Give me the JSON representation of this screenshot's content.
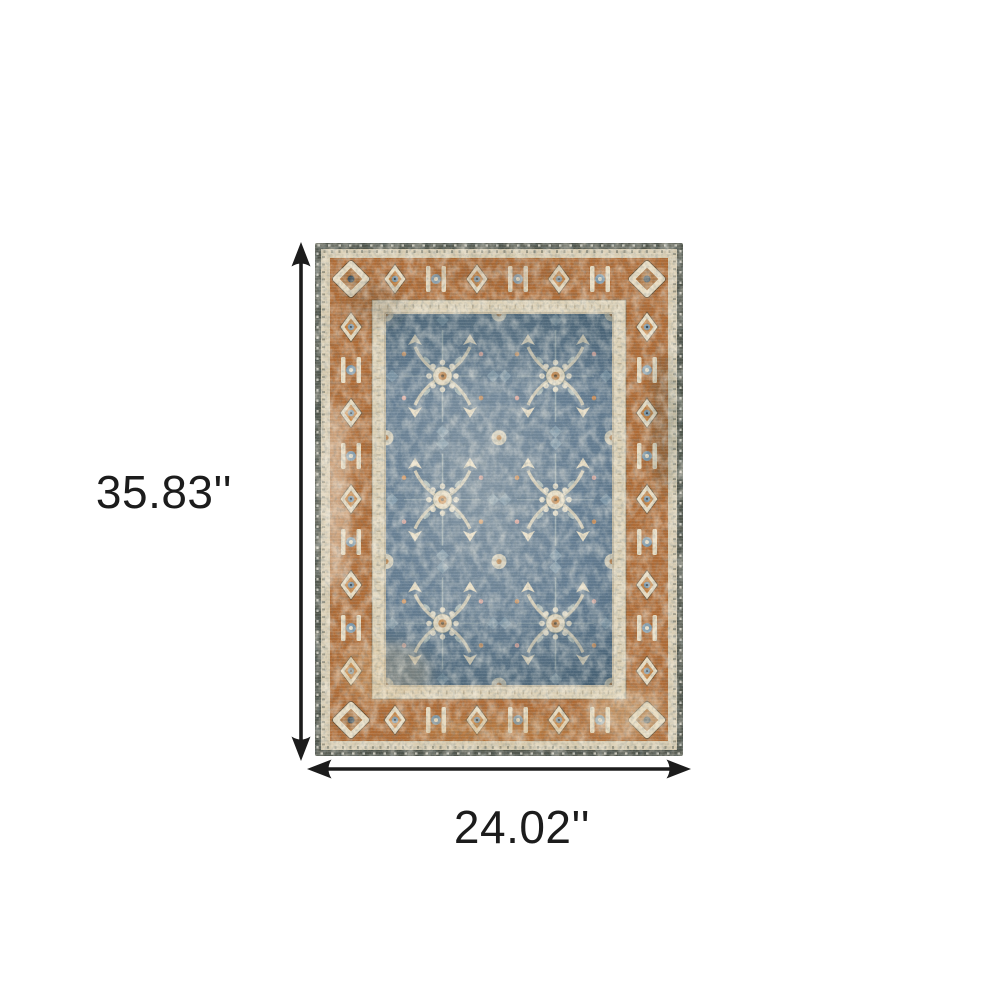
{
  "image_type": "product dimension diagram",
  "product": {
    "description": "vintage-style oriental area rug, blue floral field with rust border"
  },
  "dimensions": {
    "height_label": "35.83''",
    "width_label": "24.02''"
  },
  "colors": {
    "background": "#ffffff",
    "annotation_black": "#1c1c1c",
    "rug_dark_edge": "#4e5349",
    "rug_outer_guard": "#d8ccb1",
    "rug_border_rust": "#ae6a34",
    "rug_inner_guard": "#ddd1b6",
    "rug_field_blue": "#547089",
    "rug_motif_cream": "#e7dbc0",
    "rug_motif_blue": "#7b98ac",
    "rug_motif_orange": "#c4803f"
  }
}
